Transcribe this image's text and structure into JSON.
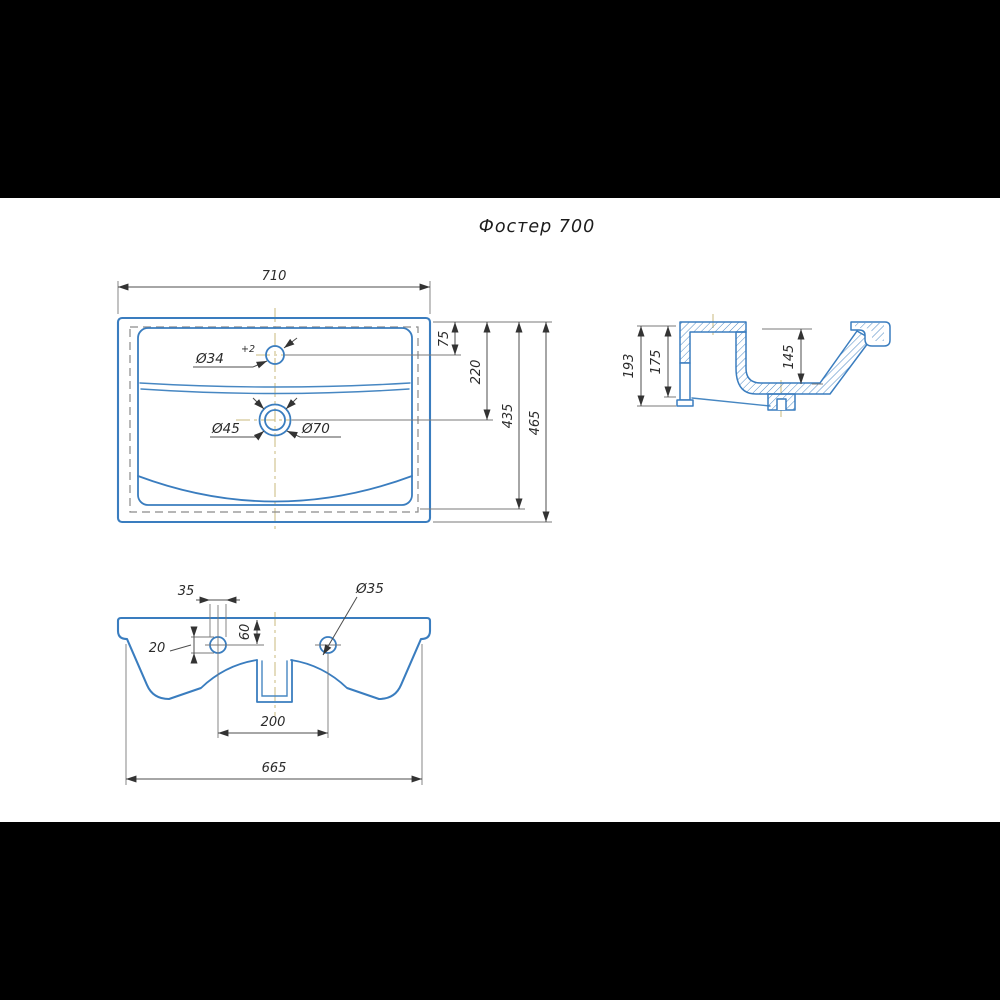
{
  "title": "Фостер 700",
  "top": {
    "width": "710",
    "faucet_offset": "75",
    "drain_offset": "220",
    "inner_length": "435",
    "depth": "465",
    "faucet_hole": "Ø34",
    "faucet_tolerance": "+2",
    "drain_inner": "Ø45",
    "drain_outer": "Ø70"
  },
  "side": {
    "total_height": "193",
    "body_height": "175",
    "basin_depth": "145"
  },
  "front": {
    "hole_diameter_linear": "35",
    "hole_edge_offset": "20",
    "hole_top_offset": "60",
    "hole_diameter": "Ø35",
    "hole_spacing": "200",
    "body_width": "665"
  },
  "colors": {
    "drawing_blue": "#3a7dbf",
    "dimension_gray": "#4d4d4d",
    "centerline_tan": "#c9b87c",
    "hidden_gray": "#8a8a8a",
    "letterbox_black": "#000000",
    "background": "#ffffff"
  }
}
